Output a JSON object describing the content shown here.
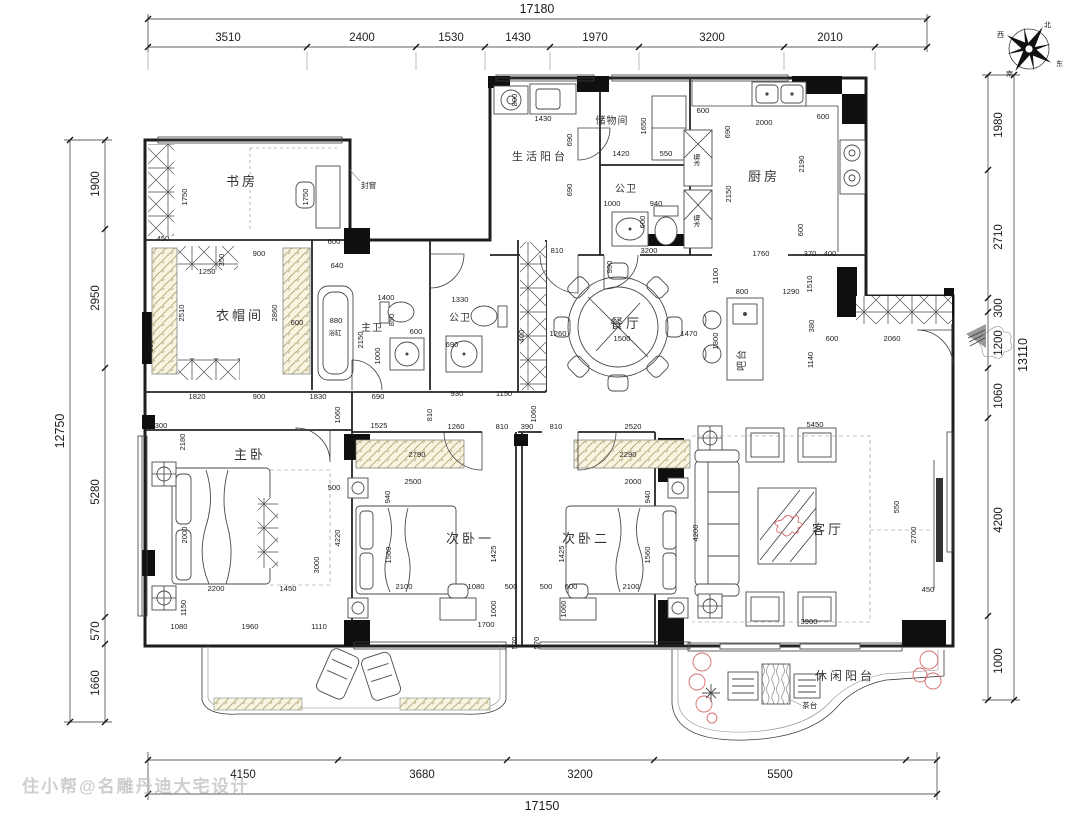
{
  "watermark": "住小帮@名雕丹迪大宅设计",
  "compass": {
    "north": "北",
    "south": "南",
    "east": "东",
    "west": "西"
  },
  "rooms": {
    "study": "书房",
    "cloakroom": "衣帽间",
    "master_bath": "主卫",
    "bath2": "公卫",
    "service_balcony": "生活阳台",
    "storage": "储物间",
    "public_bath": "公卫",
    "kitchen": "厨房",
    "dining": "餐厅",
    "bar": "吧台",
    "living": "客厅",
    "master_bed": "主卧",
    "bed2": "次卧一",
    "bed3": "次卧二",
    "leisure_balcony": "休闲阳台"
  },
  "annotations": {
    "sealed_window": "封窗",
    "bathtub": "浴缸",
    "tea_table": "茶台",
    "fridge": "冰箱"
  },
  "dims": {
    "top_total": "17180",
    "bottom_total": "17150",
    "left_total": "12750",
    "right_total": "13110",
    "top": [
      "3510",
      "2400",
      "1530",
      "1430",
      "1970",
      "3200",
      "2010"
    ],
    "bottom": [
      "4150",
      "3680",
      "3200",
      "5500"
    ],
    "left": [
      "1900",
      "2950",
      "5280",
      "570",
      "1660"
    ],
    "right": [
      "1980",
      "2710",
      "300",
      "1200",
      "1060",
      "4200",
      "1000"
    ],
    "inner": [
      "450",
      "1750",
      "1750",
      "600",
      "640",
      "1250",
      "900",
      "350",
      "2510",
      "2860",
      "600",
      "660",
      "880",
      "1400",
      "850",
      "600",
      "2150",
      "1000",
      "1330",
      "690",
      "930",
      "1150",
      "1820",
      "900",
      "1830",
      "690",
      "1430",
      "800",
      "690",
      "1420",
      "550",
      "1650",
      "690",
      "1000",
      "940",
      "600",
      "810",
      "3200",
      "600",
      "2000",
      "690",
      "2150",
      "2190",
      "600",
      "600",
      "1760",
      "370",
      "400",
      "990",
      "1260",
      "1500",
      "1470",
      "400",
      "800",
      "1290",
      "1100",
      "1510",
      "1800",
      "380",
      "600",
      "2060",
      "1140",
      "5450",
      "810",
      "1060",
      "1260",
      "810",
      "390",
      "810",
      "2520",
      "1525",
      "1060",
      "300",
      "2180",
      "500",
      "2000",
      "4220",
      "3000",
      "2200",
      "1450",
      "1150",
      "1080",
      "1960",
      "1110",
      "2790",
      "2500",
      "940",
      "1560",
      "2100",
      "1080",
      "500",
      "1425",
      "1000",
      "1700",
      "570",
      "2290",
      "2000",
      "940",
      "1560",
      "2100",
      "600",
      "500",
      "1425",
      "1060",
      "570",
      "4200",
      "550",
      "2700",
      "450",
      "3900"
    ]
  }
}
